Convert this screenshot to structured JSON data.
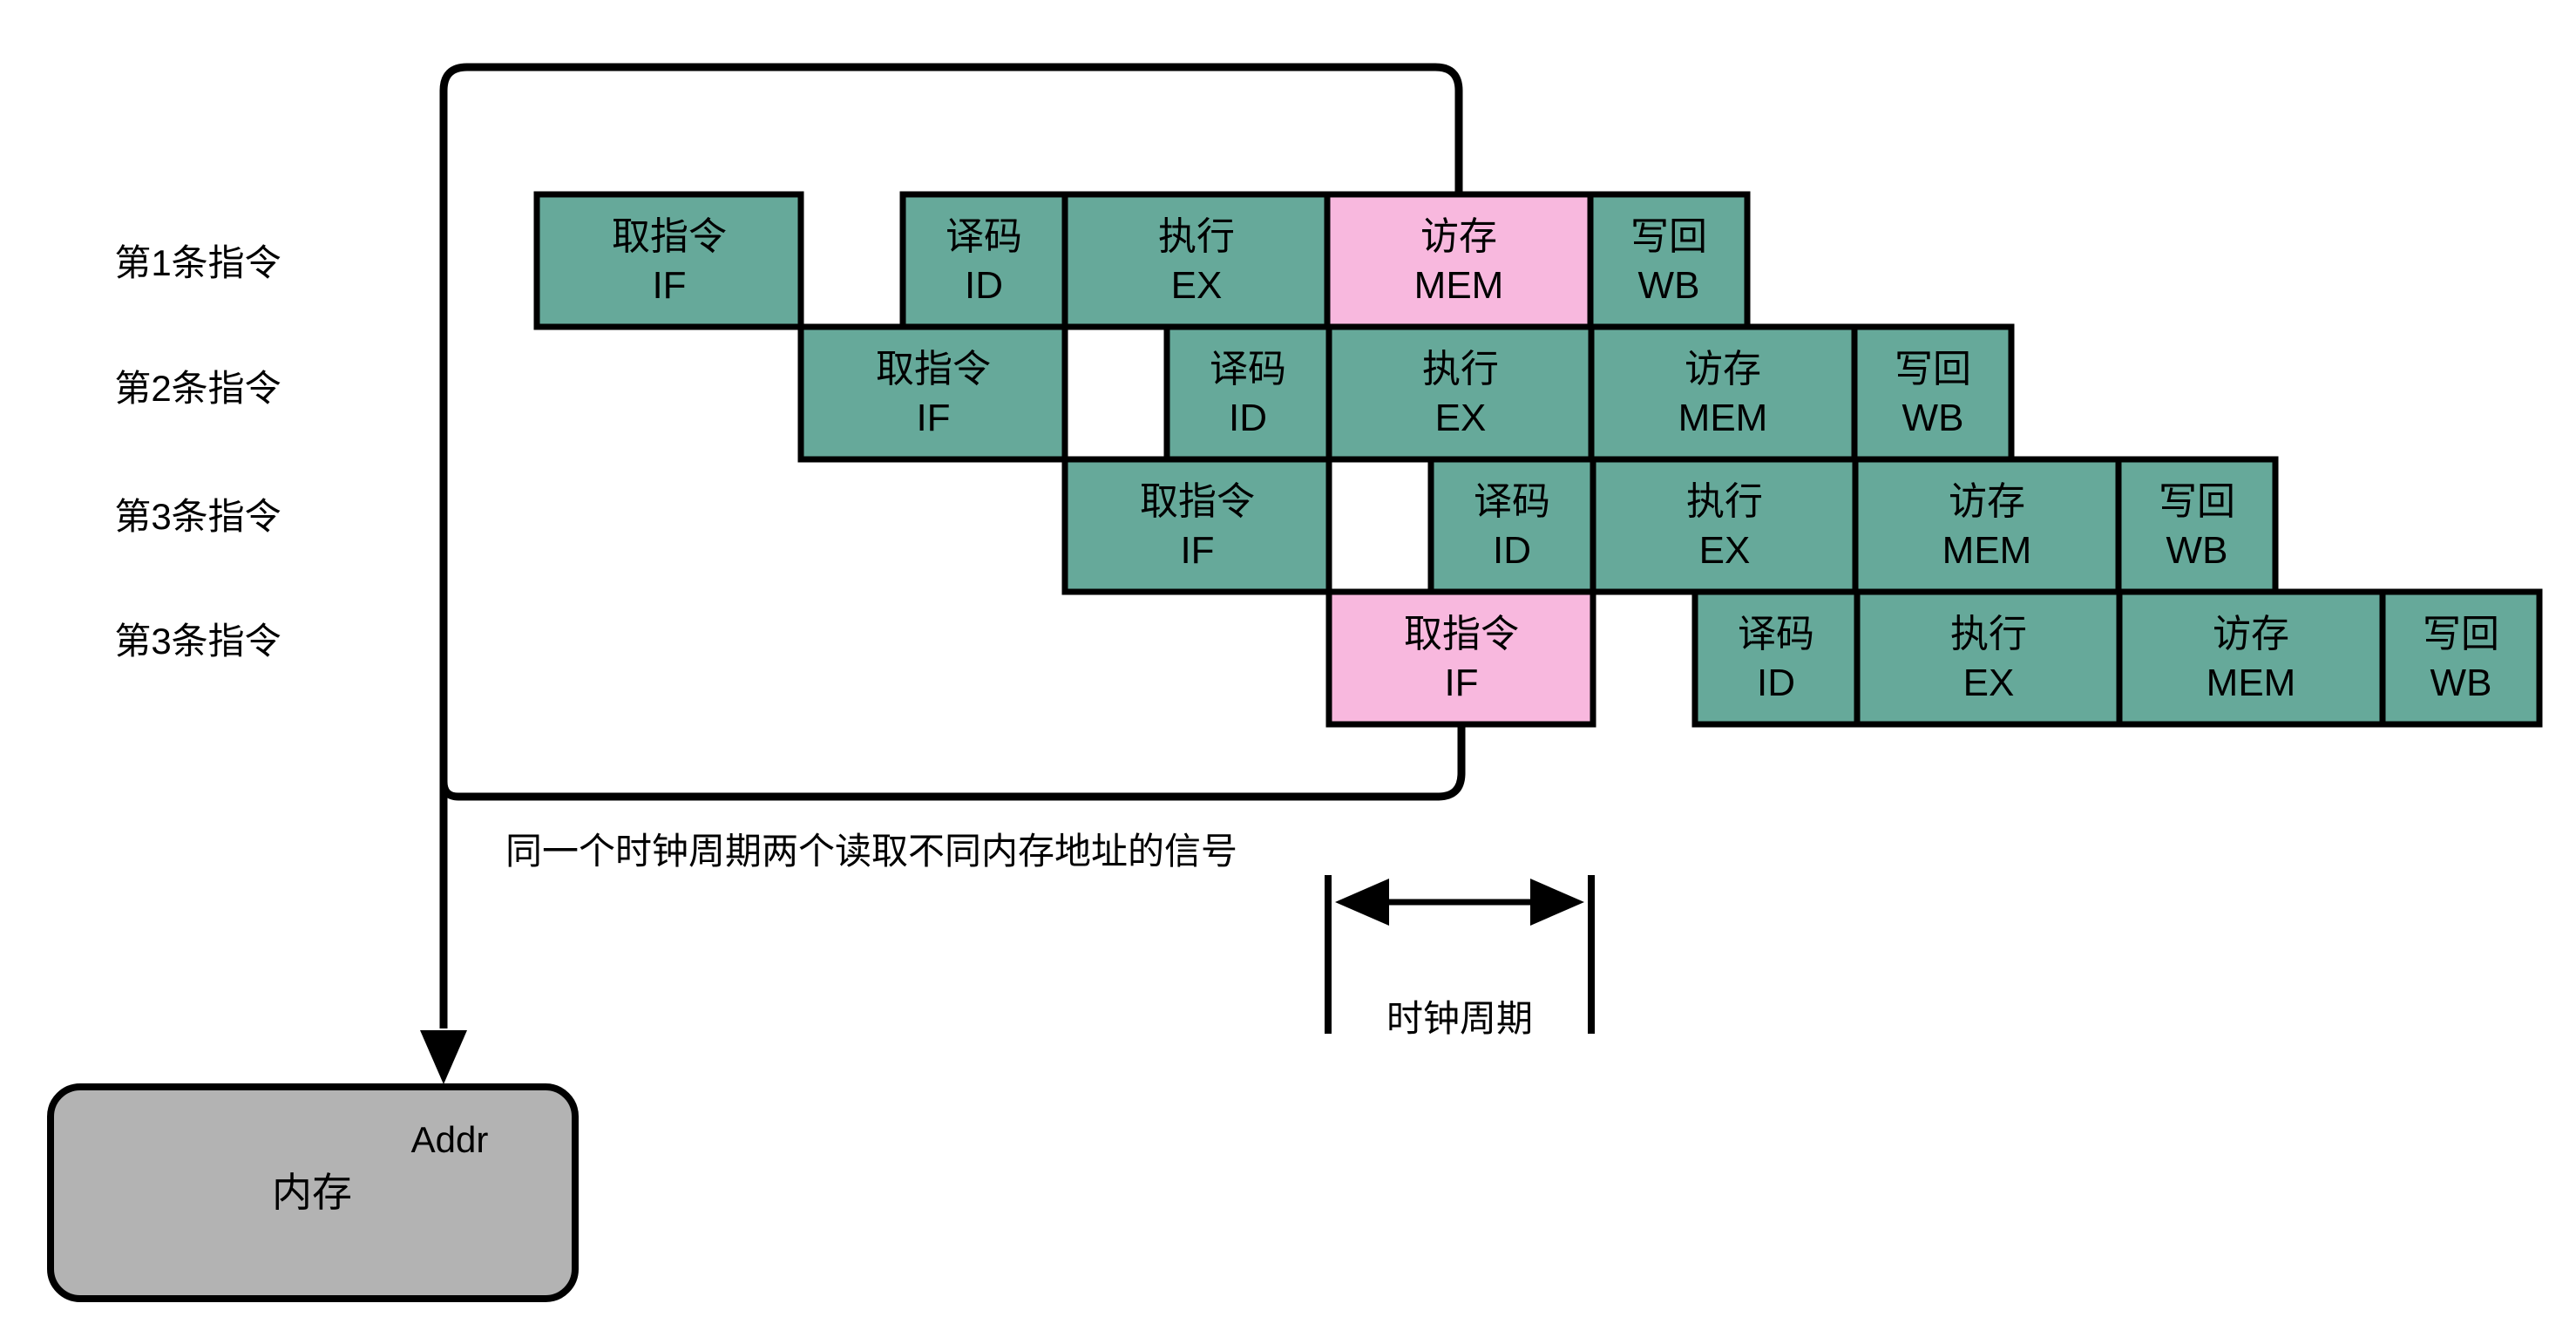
{
  "rows": [
    {
      "label": "第1条指令",
      "stages": [
        {
          "cn": "取指令",
          "en": "IF",
          "highlight": false
        },
        {
          "cn": "译码",
          "en": "ID",
          "highlight": false
        },
        {
          "cn": "执行",
          "en": "EX",
          "highlight": false
        },
        {
          "cn": "访存",
          "en": "MEM",
          "highlight": true
        },
        {
          "cn": "写回",
          "en": "WB",
          "highlight": false
        }
      ]
    },
    {
      "label": "第2条指令",
      "stages": [
        {
          "cn": "取指令",
          "en": "IF",
          "highlight": false
        },
        {
          "cn": "译码",
          "en": "ID",
          "highlight": false
        },
        {
          "cn": "执行",
          "en": "EX",
          "highlight": false
        },
        {
          "cn": "访存",
          "en": "MEM",
          "highlight": false
        },
        {
          "cn": "写回",
          "en": "WB",
          "highlight": false
        }
      ]
    },
    {
      "label": "第3条指令",
      "stages": [
        {
          "cn": "取指令",
          "en": "IF",
          "highlight": false
        },
        {
          "cn": "译码",
          "en": "ID",
          "highlight": false
        },
        {
          "cn": "执行",
          "en": "EX",
          "highlight": false
        },
        {
          "cn": "访存",
          "en": "MEM",
          "highlight": false
        },
        {
          "cn": "写回",
          "en": "WB",
          "highlight": false
        }
      ]
    },
    {
      "label": "第3条指令",
      "stages": [
        {
          "cn": "取指令",
          "en": "IF",
          "highlight": true
        },
        {
          "cn": "译码",
          "en": "ID",
          "highlight": false
        },
        {
          "cn": "执行",
          "en": "EX",
          "highlight": false
        },
        {
          "cn": "访存",
          "en": "MEM",
          "highlight": false
        },
        {
          "cn": "写回",
          "en": "WB",
          "highlight": false
        }
      ]
    }
  ],
  "annotation": "同一个时钟周期两个读取不同内存地址的信号",
  "clock": {
    "label": "时钟周期"
  },
  "memory": {
    "name": "内存",
    "port": "Addr"
  },
  "colors": {
    "stage_fill": "#66a99a",
    "highlight_fill": "#f8b8de",
    "memory_fill": "#b3b3b3",
    "line": "#000000"
  }
}
